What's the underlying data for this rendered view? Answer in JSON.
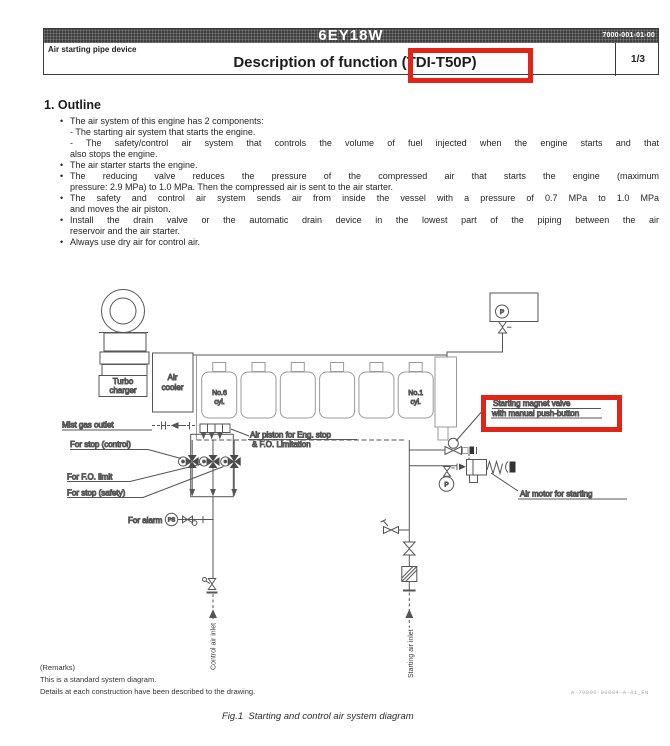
{
  "header": {
    "model": "6EY18W",
    "doc_number": "7000-001-01-00",
    "subtitle": "Air starting pipe device",
    "title": "Description of function (TDI-T50P)",
    "page": "1/3"
  },
  "outline": {
    "heading": "1. Outline",
    "lines": [
      "The air system of this engine has 2 components:",
      "- The starting air system that starts the engine.",
      "- The safety/control air system that controls the volume of fuel injected when the engine starts and that",
      "also stops the engine.",
      "The air starter starts the engine.",
      "The reducing valve reduces the pressure of the compressed air that starts the engine (maximum",
      "pressure: 2.9 MPa) to 1.0 MPa. Then the compressed air is sent to the air starter.",
      "The safety and control air system sends air from inside the vessel with a pressure of 0.7 MPa to 1.0 MPa",
      "and moves the air piston.",
      "Install the drain valve or the automatic drain device in the lowest part of the piping between the air",
      "reservoir and the air starter.",
      "Always use dry air for control air."
    ]
  },
  "diagram": {
    "labels": {
      "turbo_line1": "Turbo",
      "turbo_line2": "charger",
      "cooler_line1": "Air",
      "cooler_line2": "cooler",
      "cyl6_line1": "No.6",
      "cyl6_line2": "cyl.",
      "cyl1_line1": "No.1",
      "cyl1_line2": "cyl.",
      "gauge_p_top": "P",
      "gauge_p_motor": "P",
      "gauge_ps": "PS",
      "mist_gas_outlet": "Mist gas outlet",
      "for_stop_control": "For stop (control)",
      "for_fo_limit": "For F.O. limit",
      "for_stop_safety": "For stop (safety)",
      "for_alarm": "For alarm",
      "air_piston_line1": "Air piston for Eng. stop",
      "air_piston_line2": "& F.O. Limitation",
      "magnet_valve_line1": "Starting magnet valve",
      "magnet_valve_line2": "with manual push-button",
      "air_motor": "Air motor for starting",
      "control_air_inlet": "Control air inlet",
      "starting_air_inlet": "Starting air inlet"
    },
    "remarks": [
      "(Remarks)",
      "This is a standard system diagram.",
      "Details at each construction have been described to the drawing."
    ],
    "code": "A-70000-00004-A-01_EN",
    "caption": "Fig.1  Starting and control air system diagram"
  },
  "colors": {
    "highlight_red": "#e02417",
    "header_bar": "#3f3f3f"
  }
}
